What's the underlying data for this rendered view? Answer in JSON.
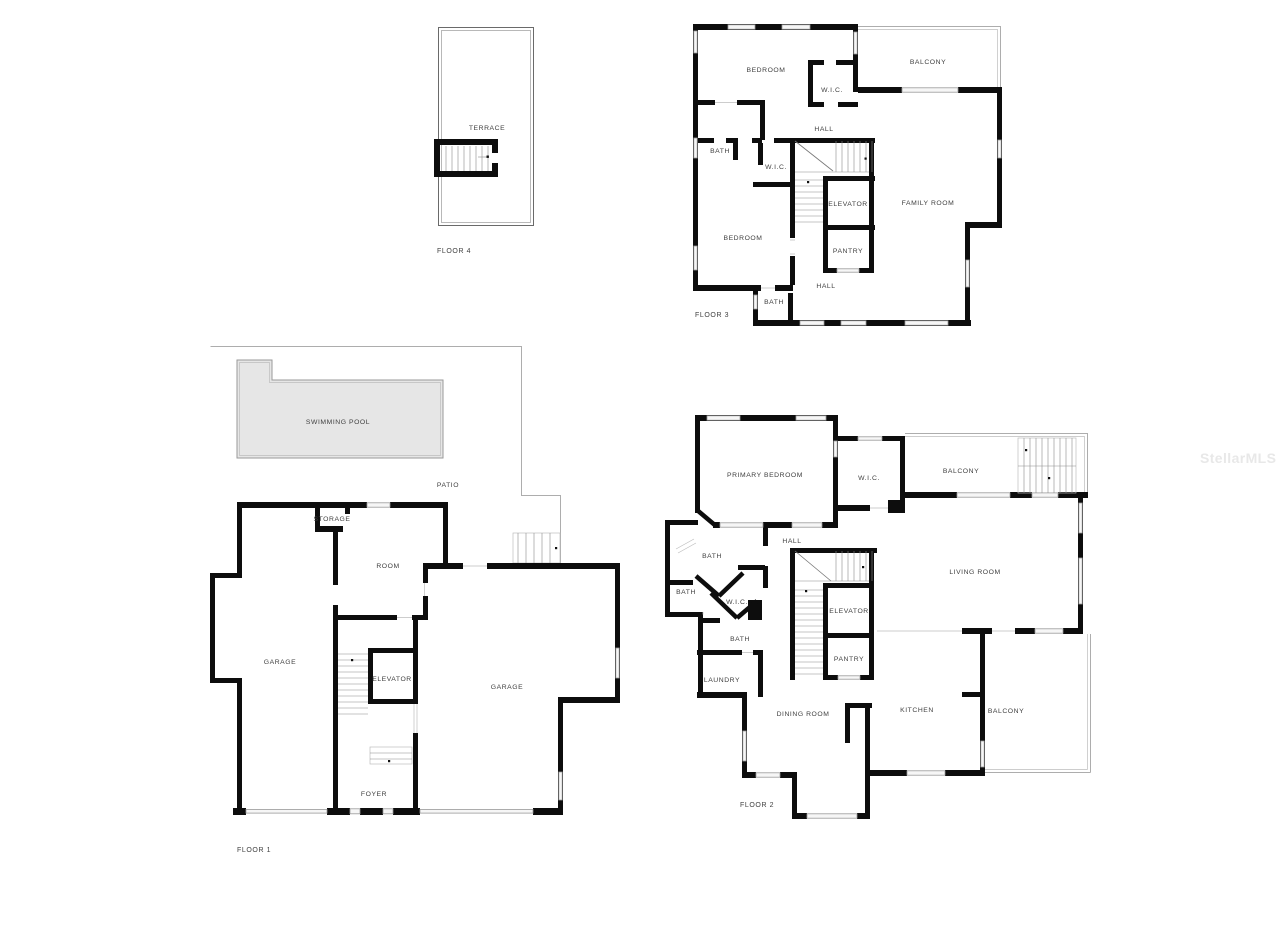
{
  "watermark": "StellarMLS",
  "palette": {
    "wall": "#0d0d0d",
    "window": "#f6f6f6",
    "pool_fill": "#e6e6e6",
    "thin_outline": "#adadad",
    "label_text": "#3f3f3f",
    "watermark_text": "#e8e8e8",
    "background": "#ffffff"
  },
  "floor4": {
    "label": "FLOOR 4",
    "terrace": "TERRACE"
  },
  "floor3": {
    "label": "FLOOR 3",
    "bedroom_top": "BEDROOM",
    "wic_top": "W.I.C.",
    "balcony": "BALCONY",
    "hall_top": "HALL",
    "bath_top": "BATH",
    "wic_mid": "W.I.C.",
    "bedroom_bottom": "BEDROOM",
    "elevator": "ELEVATOR",
    "pantry": "PANTRY",
    "family_room": "FAMILY ROOM",
    "hall_bottom": "HALL",
    "bath_bottom": "BATH"
  },
  "floor1": {
    "label": "FLOOR 1",
    "swimming_pool": "SWIMMING POOL",
    "patio": "PATIO",
    "storage": "STORAGE",
    "room": "ROOM",
    "garage_left": "GARAGE",
    "garage_right": "GARAGE",
    "elevator": "ELEVATOR",
    "foyer": "FOYER"
  },
  "floor2": {
    "label": "FLOOR 2",
    "primary_bedroom": "PRIMARY BEDROOM",
    "wic_top": "W.I.C.",
    "balcony_top": "BALCONY",
    "hall": "HALL",
    "bath_top": "BATH",
    "bath_left": "BATH",
    "wic_mid": "W.I.C.",
    "bath_mid": "BATH",
    "elevator": "ELEVATOR",
    "pantry": "PANTRY",
    "laundry": "LAUNDRY",
    "living_room": "LIVING ROOM",
    "dining_room": "DINING ROOM",
    "kitchen": "KITCHEN",
    "balcony_right": "BALCONY"
  }
}
